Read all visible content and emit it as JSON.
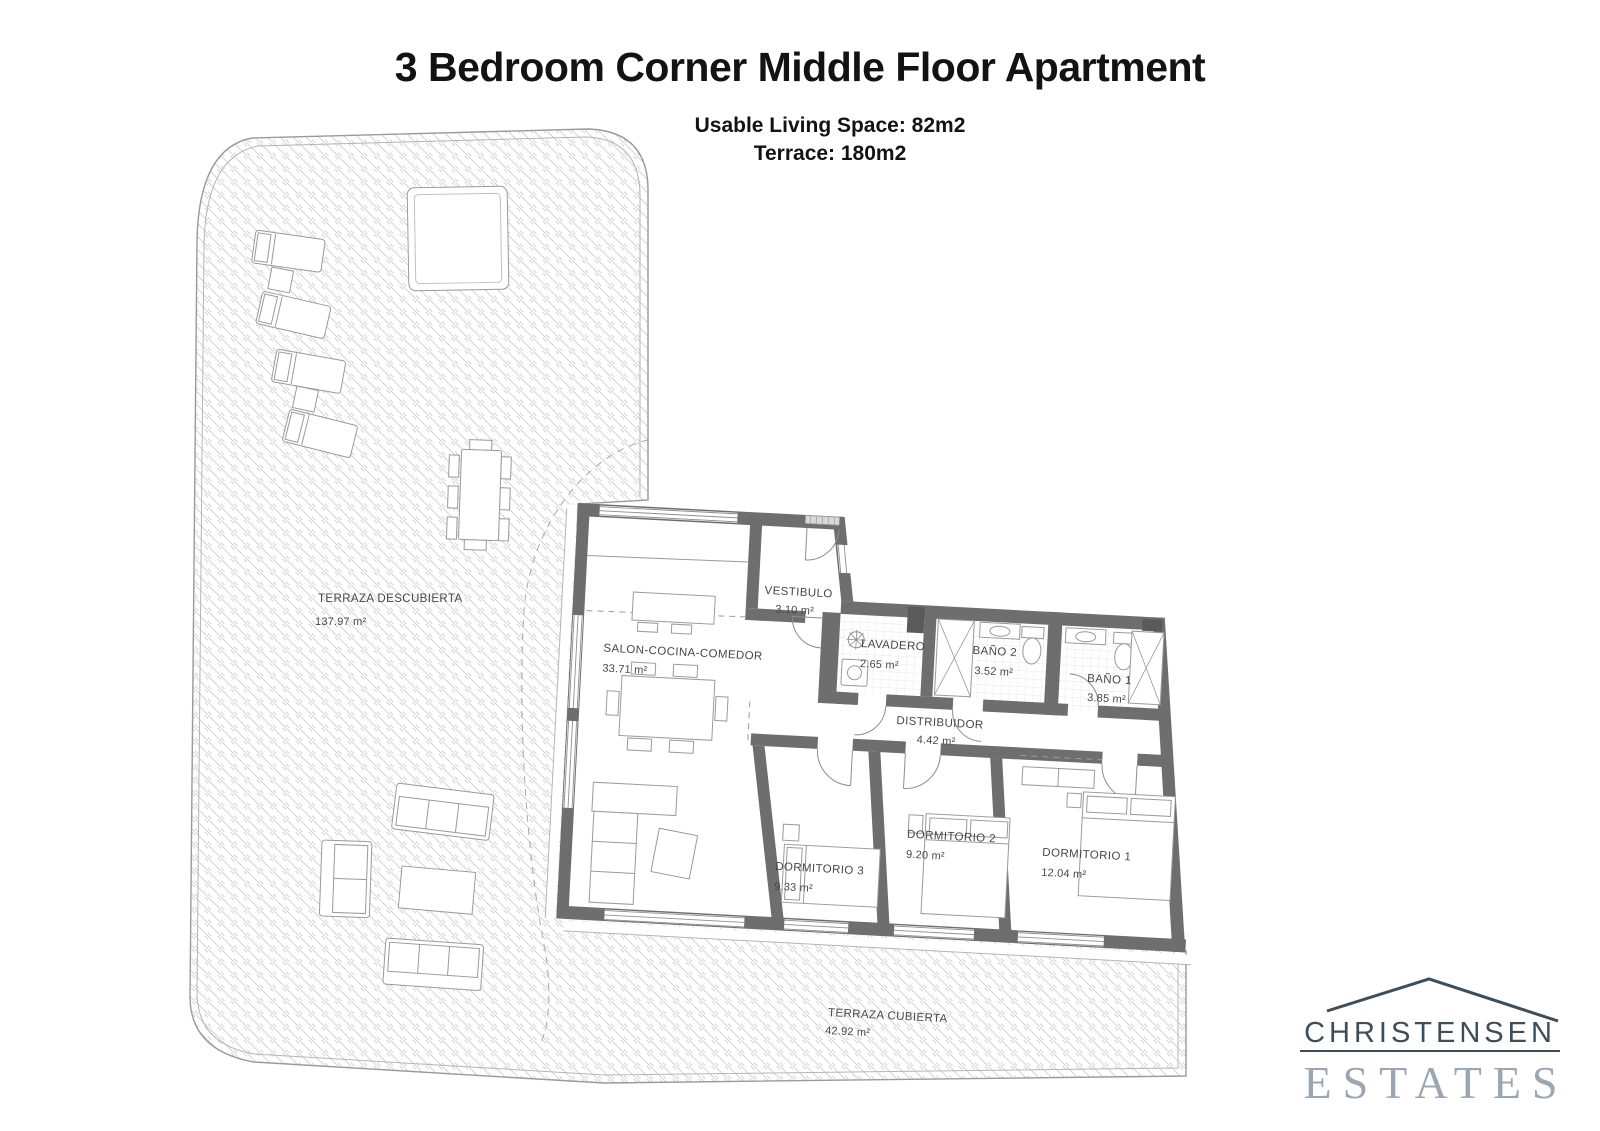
{
  "header": {
    "title": "3 Bedroom Corner Middle Floor Apartment",
    "subtitle_line1": "Usable Living Space: 82m2",
    "subtitle_line2": "Terrace: 180m2"
  },
  "floor_plan": {
    "rooms": [
      {
        "id": "terraza-descubierta",
        "label": "TERRAZA DESCUBIERTA",
        "area": "137.97 m²"
      },
      {
        "id": "salon-cocina-comedor",
        "label": "SALON-COCINA-COMEDOR",
        "area": "33.71 m²"
      },
      {
        "id": "vestibulo",
        "label": "VESTIBULO",
        "area": "3.10 m²"
      },
      {
        "id": "lavadero",
        "label": "LAVADERO",
        "area": "2.65 m²"
      },
      {
        "id": "bano-2",
        "label": "BAÑO 2",
        "area": "3.52 m²"
      },
      {
        "id": "bano-1",
        "label": "BAÑO 1",
        "area": "3.85 m²"
      },
      {
        "id": "distribuidor",
        "label": "DISTRIBUIDOR",
        "area": "4.42 m²"
      },
      {
        "id": "dormitorio-3",
        "label": "DORMITORIO 3",
        "area": "9.33 m²"
      },
      {
        "id": "dormitorio-2",
        "label": "DORMITORIO 2",
        "area": "9.20 m²"
      },
      {
        "id": "dormitorio-1",
        "label": "DORMITORIO 1",
        "area": "12.04 m²"
      },
      {
        "id": "terraza-cubierta",
        "label": "TERRAZA CUBIERTA",
        "area": "42.92 m²"
      }
    ]
  },
  "logo": {
    "name": "CHRISTENSEN",
    "type": "ESTATES"
  },
  "colors": {
    "wall": "#6e6e6e",
    "hatch": "#d4d4d4",
    "logo_primary": "#3e4d5a",
    "logo_secondary": "#9aa7b3"
  }
}
